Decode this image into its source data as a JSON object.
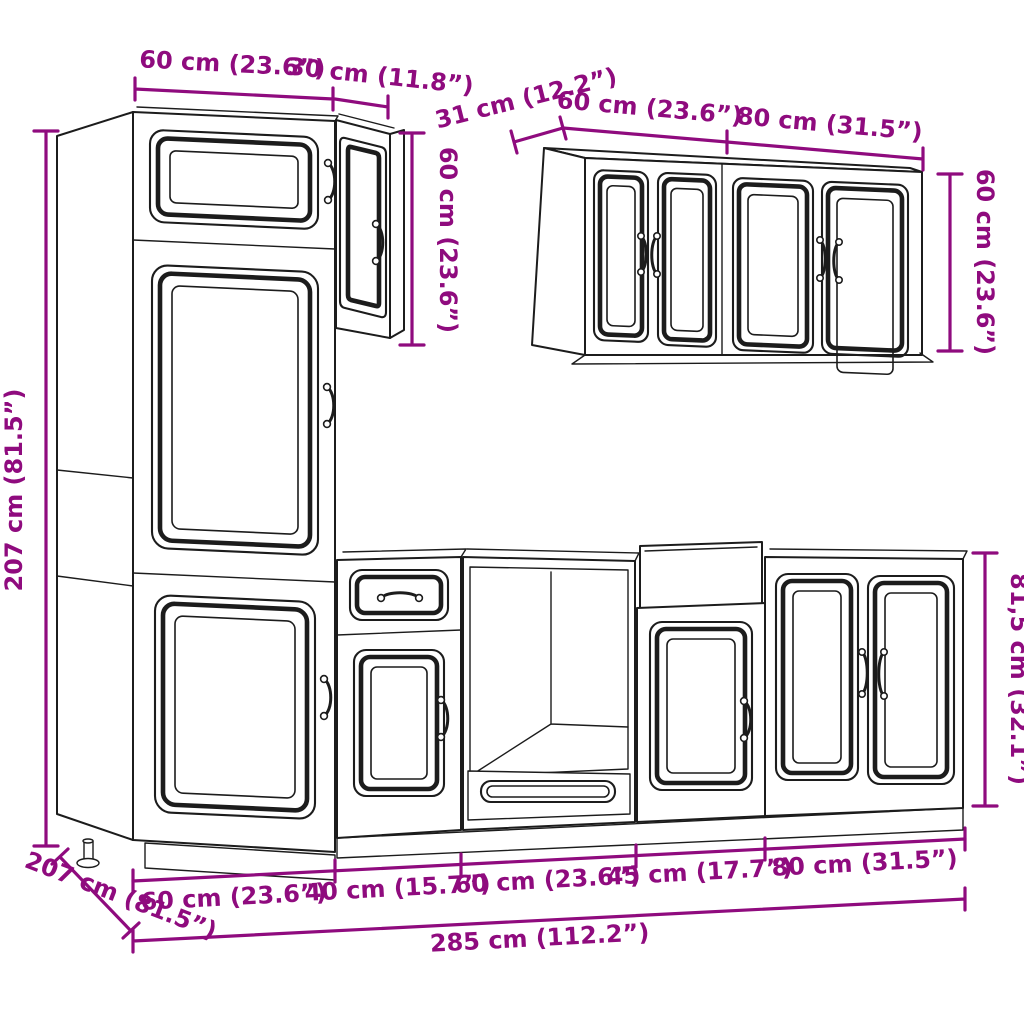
{
  "image": {
    "width": 1024,
    "height": 1024,
    "background": "#FFFFFF",
    "description": "Kitchen cabinet set line drawing with dimension annotations"
  },
  "style": {
    "dimension_color": "#8F0B7E",
    "line_color": "#1C1C1C"
  },
  "labels": {
    "tall_width": "60 cm (23.6”)",
    "wall_small_width": "30 cm (11.8”)",
    "wall_small_height": "60 cm (23.6”)",
    "tall_height": "207 cm (81.5”)",
    "wall_depth": "31 cm (12.2”)",
    "wall_60_width": "60 cm (23.6”)",
    "wall_80_width": "80 cm (31.5”)",
    "wall_height": "60 cm (23.6”)",
    "base_height": "81,5 cm (32.1”)",
    "floor_depth": "207 cm (81.5”)",
    "base_60a_width": "60 cm (23.6”)",
    "base_40_width": "40 cm (15.7”)",
    "base_60b_width": "60 cm (23.6”)",
    "base_45_width": "45 cm (17.7”)",
    "base_80_width": "80 cm (31.5”)",
    "total_width": "285 cm (112.2”)"
  }
}
